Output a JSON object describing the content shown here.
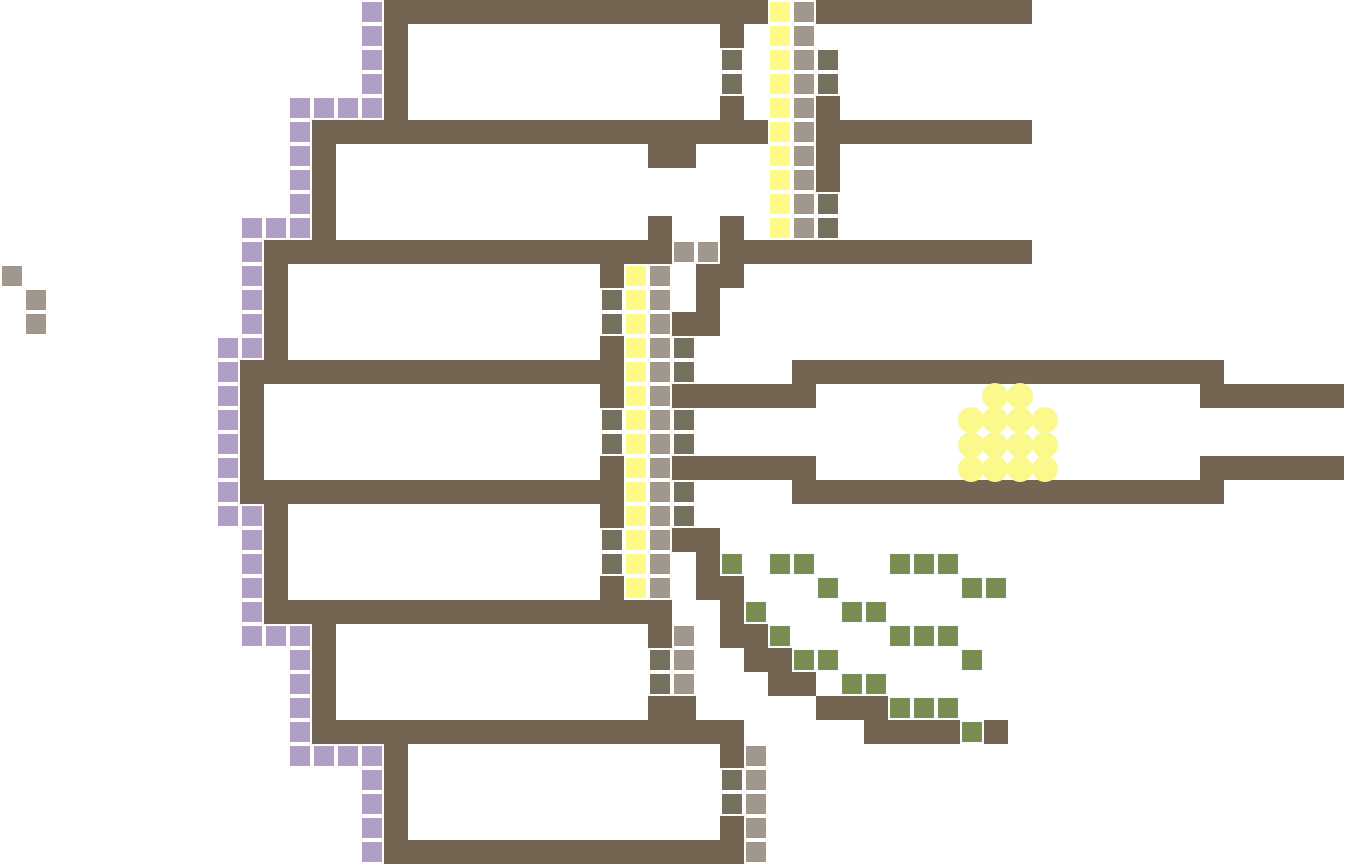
{
  "board": {
    "width": 1345,
    "height": 865,
    "cell_size": 24,
    "tile_size": 20,
    "tile_offset": 2,
    "background_color": "#ffffff"
  },
  "colors": {
    "wall": "#746452",
    "purple": "#b19ec6",
    "yellow": "#fdfb85",
    "tan": "#a0968c",
    "dark": "#76705f",
    "green": "#798c52",
    "egg": "#fbf98b"
  },
  "walls": [
    [
      16,
      0,
      16,
      1
    ],
    [
      34,
      0,
      9,
      1
    ],
    [
      16,
      1,
      1,
      4
    ],
    [
      30,
      1,
      1,
      1
    ],
    [
      30,
      4,
      1,
      1
    ],
    [
      14,
      5,
      18,
      1
    ],
    [
      35,
      5,
      8,
      1
    ],
    [
      34,
      4,
      1,
      4
    ],
    [
      13,
      5,
      1,
      5
    ],
    [
      27,
      6,
      2,
      1
    ],
    [
      27,
      9,
      1,
      1
    ],
    [
      30,
      9,
      1,
      1
    ],
    [
      11,
      10,
      17,
      1
    ],
    [
      30,
      10,
      13,
      1
    ],
    [
      11,
      11,
      1,
      4
    ],
    [
      25,
      11,
      1,
      1
    ],
    [
      29,
      11,
      2,
      1
    ],
    [
      29,
      12,
      1,
      1
    ],
    [
      28,
      13,
      2,
      1
    ],
    [
      10,
      15,
      15,
      1
    ],
    [
      25,
      14,
      1,
      3
    ],
    [
      10,
      16,
      1,
      4
    ],
    [
      33,
      15,
      18,
      1
    ],
    [
      28,
      16,
      6,
      1
    ],
    [
      50,
      16,
      6,
      1
    ],
    [
      28,
      19,
      6,
      1
    ],
    [
      50,
      19,
      6,
      1
    ],
    [
      10,
      20,
      15,
      1
    ],
    [
      33,
      20,
      18,
      1
    ],
    [
      25,
      19,
      1,
      3
    ],
    [
      11,
      21,
      1,
      4
    ],
    [
      28,
      22,
      2,
      1
    ],
    [
      25,
      24,
      1,
      1
    ],
    [
      11,
      25,
      17,
      1
    ],
    [
      27,
      26,
      1,
      1
    ],
    [
      13,
      26,
      1,
      5
    ],
    [
      27,
      29,
      2,
      1
    ],
    [
      14,
      30,
      17,
      1
    ],
    [
      30,
      31,
      1,
      1
    ],
    [
      16,
      31,
      1,
      4
    ],
    [
      16,
      35,
      14,
      1
    ],
    [
      30,
      34,
      1,
      2
    ],
    [
      29,
      23,
      1,
      2
    ],
    [
      30,
      24,
      1,
      3
    ],
    [
      31,
      26,
      1,
      2
    ],
    [
      32,
      27,
      1,
      2
    ],
    [
      33,
      28,
      1,
      1
    ],
    [
      34,
      29,
      3,
      1
    ],
    [
      36,
      30,
      4,
      1
    ],
    [
      41,
      30,
      1,
      1
    ]
  ],
  "tiles": {
    "purple": [
      [
        15,
        0
      ],
      [
        15,
        1
      ],
      [
        15,
        2
      ],
      [
        15,
        3
      ],
      [
        12,
        4
      ],
      [
        13,
        4
      ],
      [
        14,
        4
      ],
      [
        15,
        4
      ],
      [
        12,
        5
      ],
      [
        12,
        6
      ],
      [
        12,
        7
      ],
      [
        12,
        8
      ],
      [
        10,
        9
      ],
      [
        11,
        9
      ],
      [
        12,
        9
      ],
      [
        10,
        10
      ],
      [
        10,
        11
      ],
      [
        10,
        12
      ],
      [
        10,
        13
      ],
      [
        9,
        14
      ],
      [
        10,
        14
      ],
      [
        9,
        15
      ],
      [
        9,
        16
      ],
      [
        9,
        17
      ],
      [
        9,
        18
      ],
      [
        9,
        19
      ],
      [
        9,
        20
      ],
      [
        9,
        21
      ],
      [
        10,
        21
      ],
      [
        10,
        22
      ],
      [
        10,
        23
      ],
      [
        10,
        24
      ],
      [
        10,
        25
      ],
      [
        10,
        26
      ],
      [
        11,
        26
      ],
      [
        12,
        26
      ],
      [
        12,
        27
      ],
      [
        12,
        28
      ],
      [
        12,
        29
      ],
      [
        12,
        30
      ],
      [
        12,
        31
      ],
      [
        13,
        31
      ],
      [
        14,
        31
      ],
      [
        15,
        31
      ],
      [
        15,
        32
      ],
      [
        15,
        33
      ],
      [
        15,
        34
      ],
      [
        15,
        35
      ]
    ],
    "yellow": [
      [
        32,
        0
      ],
      [
        32,
        1
      ],
      [
        32,
        2
      ],
      [
        32,
        3
      ],
      [
        32,
        4
      ],
      [
        32,
        5
      ],
      [
        32,
        6
      ],
      [
        32,
        7
      ],
      [
        32,
        8
      ],
      [
        32,
        9
      ],
      [
        26,
        11
      ],
      [
        26,
        12
      ],
      [
        26,
        13
      ],
      [
        26,
        14
      ],
      [
        26,
        15
      ],
      [
        26,
        16
      ],
      [
        26,
        17
      ],
      [
        26,
        18
      ],
      [
        26,
        19
      ],
      [
        26,
        20
      ],
      [
        26,
        21
      ],
      [
        26,
        22
      ],
      [
        26,
        23
      ],
      [
        26,
        24
      ]
    ],
    "tan": [
      [
        33,
        0
      ],
      [
        33,
        1
      ],
      [
        33,
        2
      ],
      [
        33,
        3
      ],
      [
        33,
        4
      ],
      [
        33,
        5
      ],
      [
        33,
        6
      ],
      [
        33,
        7
      ],
      [
        33,
        8
      ],
      [
        33,
        9
      ],
      [
        28,
        10
      ],
      [
        29,
        10
      ],
      [
        27,
        11
      ],
      [
        27,
        12
      ],
      [
        27,
        13
      ],
      [
        27,
        14
      ],
      [
        27,
        15
      ],
      [
        27,
        16
      ],
      [
        27,
        17
      ],
      [
        27,
        18
      ],
      [
        27,
        19
      ],
      [
        27,
        20
      ],
      [
        27,
        21
      ],
      [
        27,
        22
      ],
      [
        27,
        23
      ],
      [
        27,
        24
      ],
      [
        28,
        26
      ],
      [
        28,
        27
      ],
      [
        28,
        28
      ],
      [
        31,
        31
      ],
      [
        31,
        32
      ],
      [
        31,
        33
      ],
      [
        31,
        34
      ],
      [
        31,
        35
      ],
      [
        0,
        11
      ],
      [
        1,
        12
      ],
      [
        1,
        13
      ]
    ],
    "dark": [
      [
        30,
        2
      ],
      [
        30,
        3
      ],
      [
        34,
        2
      ],
      [
        34,
        3
      ],
      [
        34,
        8
      ],
      [
        34,
        9
      ],
      [
        25,
        12
      ],
      [
        25,
        13
      ],
      [
        28,
        14
      ],
      [
        28,
        15
      ],
      [
        25,
        17
      ],
      [
        25,
        18
      ],
      [
        28,
        17
      ],
      [
        28,
        18
      ],
      [
        28,
        20
      ],
      [
        28,
        21
      ],
      [
        25,
        22
      ],
      [
        25,
        23
      ],
      [
        27,
        27
      ],
      [
        27,
        28
      ],
      [
        30,
        32
      ],
      [
        30,
        33
      ]
    ],
    "green": [
      [
        30,
        23
      ],
      [
        32,
        23
      ],
      [
        33,
        23
      ],
      [
        37,
        23
      ],
      [
        38,
        23
      ],
      [
        39,
        23
      ],
      [
        34,
        24
      ],
      [
        40,
        24
      ],
      [
        41,
        24
      ],
      [
        31,
        25
      ],
      [
        35,
        25
      ],
      [
        36,
        25
      ],
      [
        32,
        26
      ],
      [
        37,
        26
      ],
      [
        38,
        26
      ],
      [
        39,
        26
      ],
      [
        33,
        27
      ],
      [
        34,
        27
      ],
      [
        40,
        27
      ],
      [
        35,
        28
      ],
      [
        36,
        28
      ],
      [
        37,
        29
      ],
      [
        38,
        29
      ],
      [
        39,
        29
      ],
      [
        40,
        30
      ]
    ]
  },
  "eggs": {
    "radius": 13,
    "centers": [
      [
        995,
        396
      ],
      [
        1020,
        396
      ],
      [
        971,
        420
      ],
      [
        995,
        420
      ],
      [
        1020,
        420
      ],
      [
        1045,
        420
      ],
      [
        971,
        445
      ],
      [
        995,
        445
      ],
      [
        1020,
        445
      ],
      [
        1045,
        445
      ],
      [
        971,
        469
      ],
      [
        995,
        469
      ],
      [
        1020,
        469
      ],
      [
        1045,
        469
      ]
    ]
  }
}
